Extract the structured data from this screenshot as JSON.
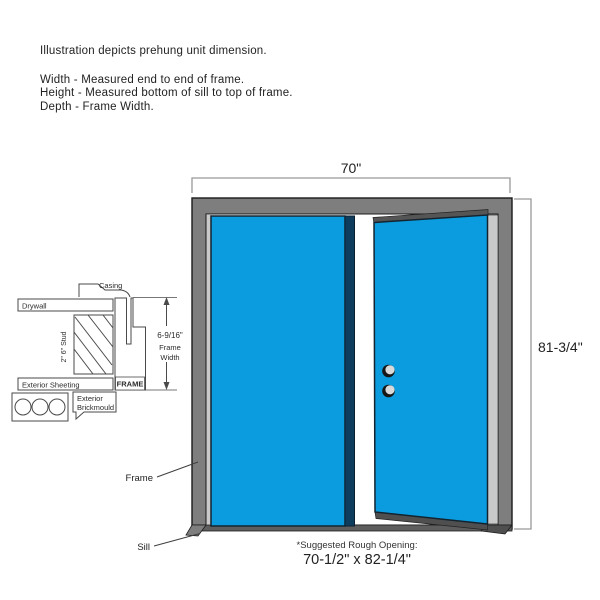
{
  "note": {
    "intro": "Illustration depicts prehung unit dimension.",
    "width_line": "Width - Measured end to end of frame.",
    "height_line": "Height - Measured bottom of sill to top of frame.",
    "depth_line": "Depth - Frame Width."
  },
  "diagram": {
    "width_dim": "70\"",
    "height_dim": "81-3/4\"",
    "frame_callout": "Frame",
    "sill_callout": "Sill",
    "rough_opening_label": "*Suggested Rough Opening:",
    "rough_opening_value": "70-1/2\" x 82-1/4\""
  },
  "cross_section": {
    "casing": "Casing",
    "drywall": "Drywall",
    "stud": "2\" 6\" Stud",
    "exterior_sheeting": "Exterior Sheeting",
    "exterior_brickmould_line1": "Exterior",
    "exterior_brickmould_line2": "Brickmould",
    "frame": "FRAME",
    "frame_width_value": "6-9/16\"",
    "frame_width_line1": "Frame",
    "frame_width_line2": "Width"
  },
  "colors": {
    "door_blue": "#0A9CDE",
    "door_edge_dark": "#0E3C5C",
    "frame_gray": "#7E7E7E",
    "liner_gray": "#C9C9C9",
    "sill_gray": "#5E5E5E",
    "shadow_gray": "#4F4F4F",
    "outline": "#1B1B1B",
    "dim_line": "#999999",
    "detail_line": "#4A4A4A"
  }
}
